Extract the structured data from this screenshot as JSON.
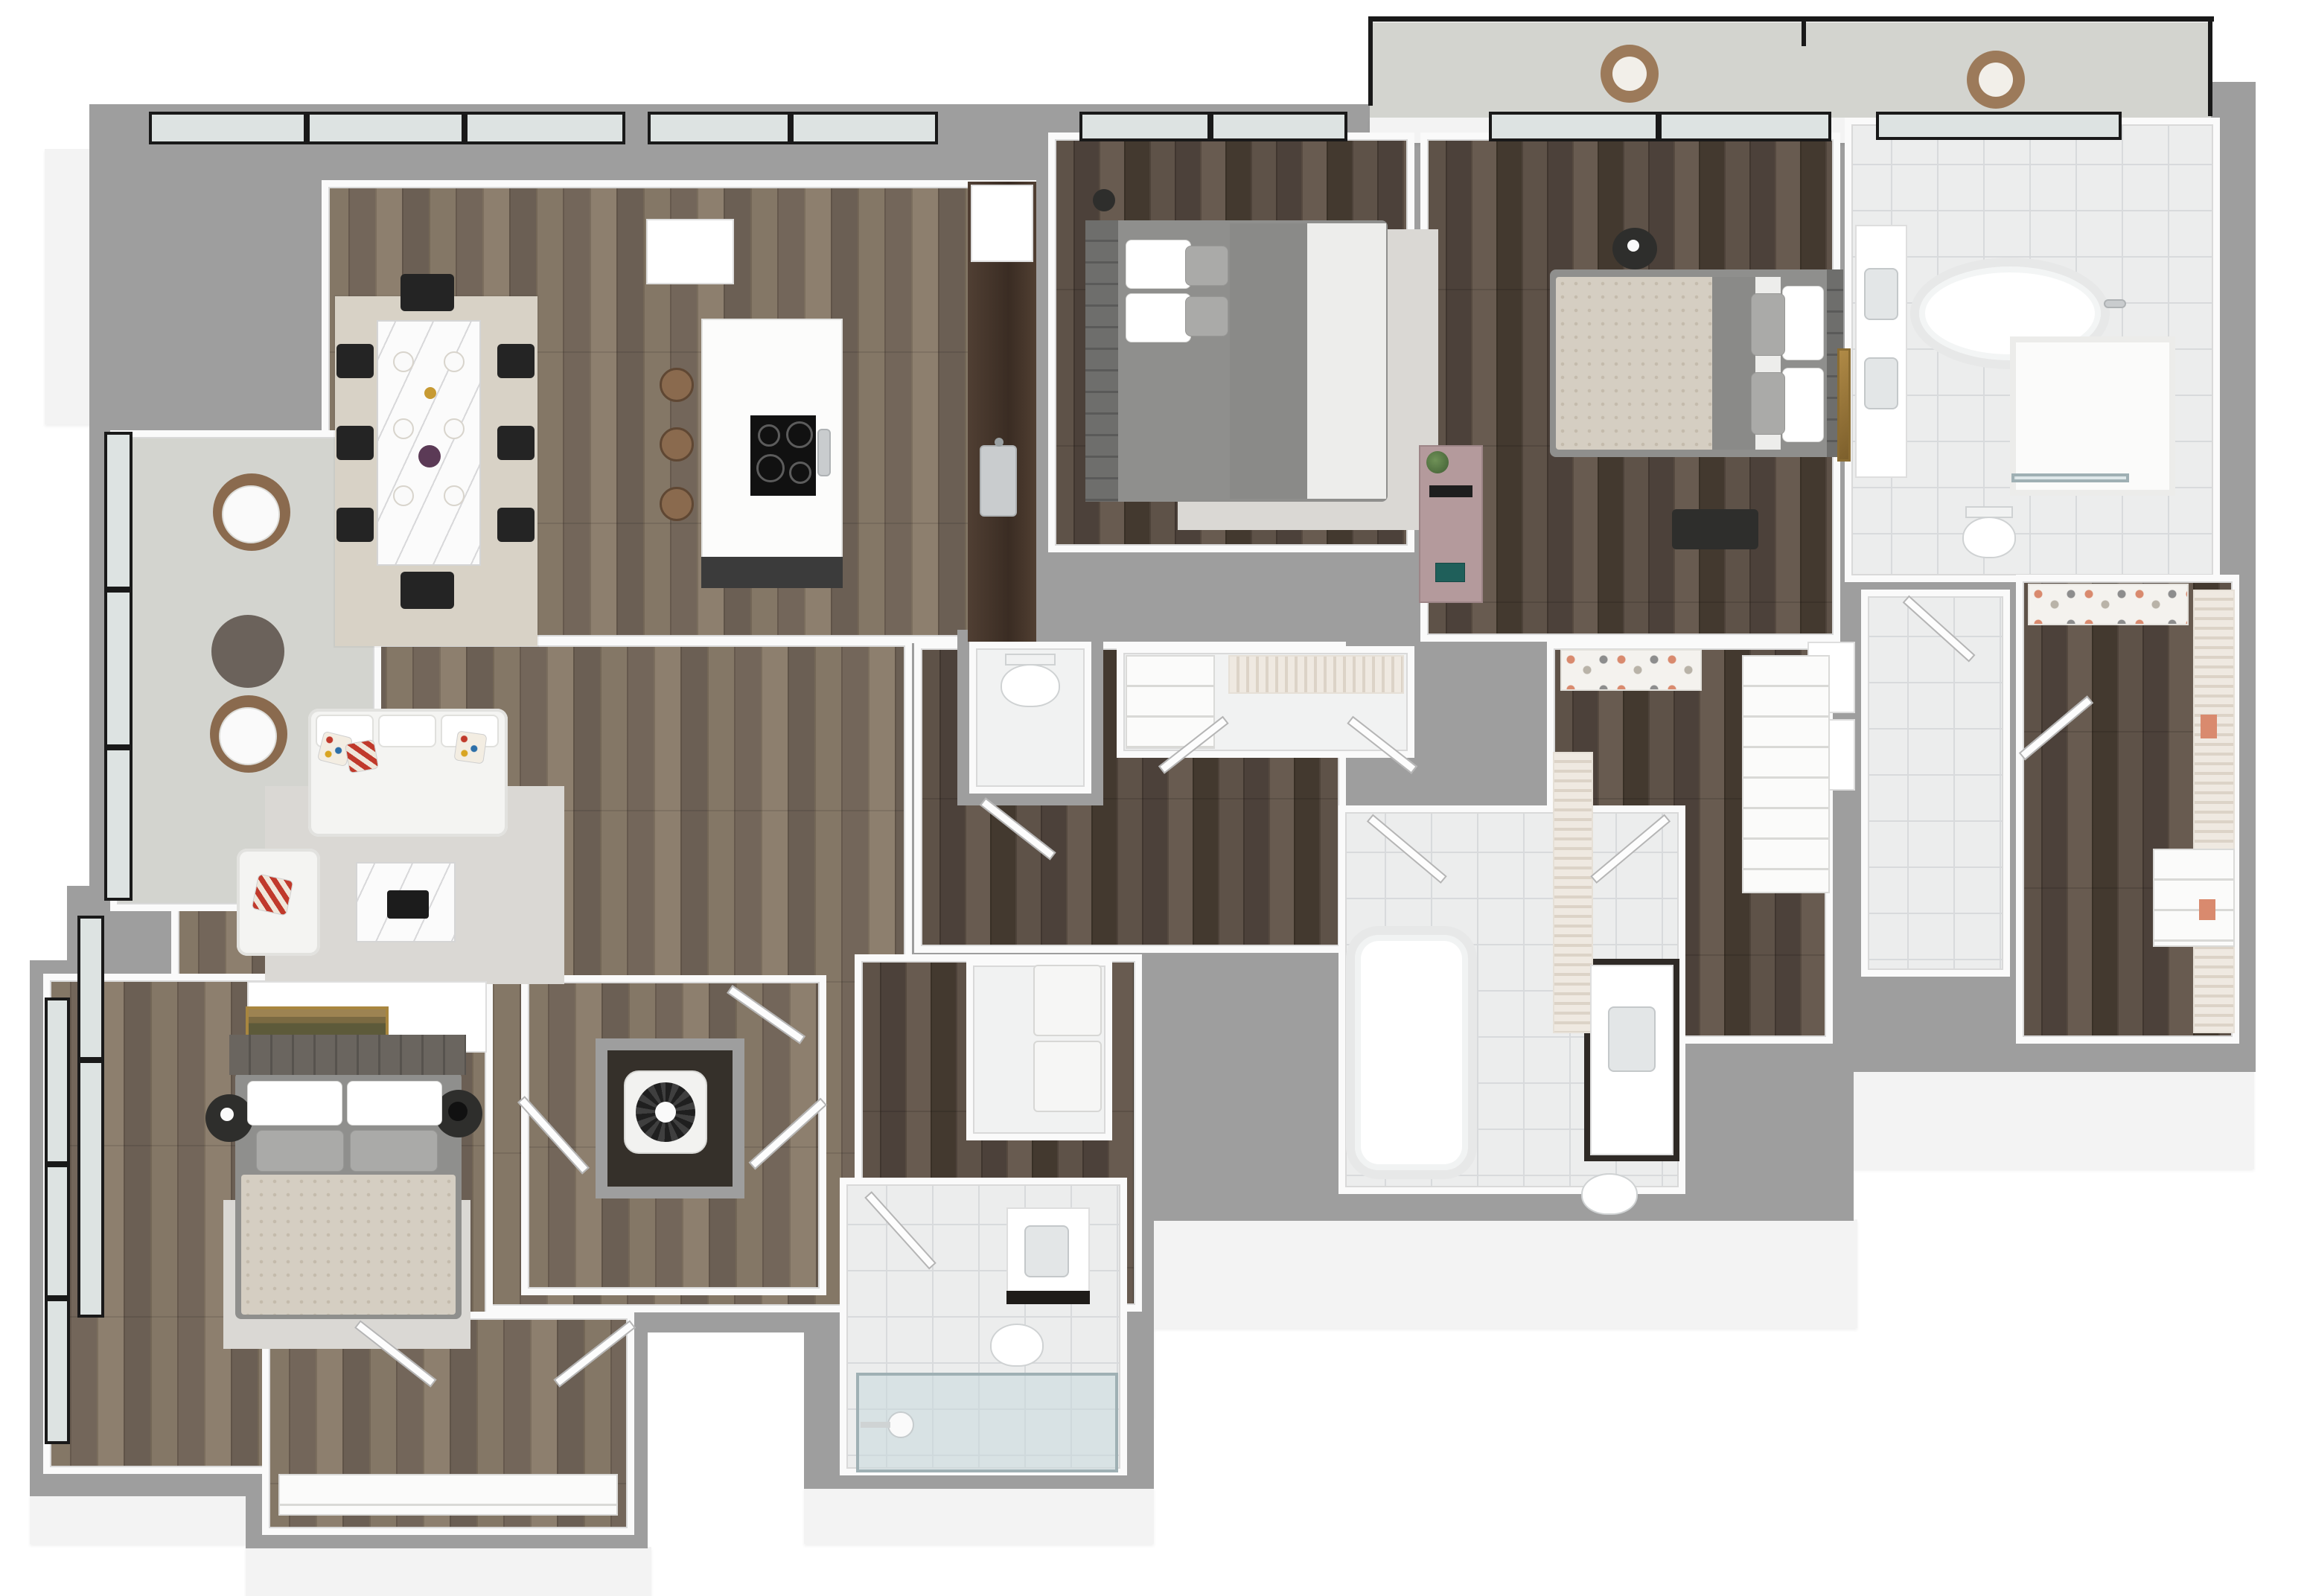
{
  "meta": {
    "title": "3D rendered apartment floor plan, isometric top-down view, no text labels"
  },
  "palette": {
    "wall": "#9e9e9e",
    "face": "#f3f3f3",
    "white": "#fafafa",
    "glass": "#dde3e2",
    "frame": "#191919",
    "tile": "#eceded",
    "tileLine": "#d8dadc",
    "balcony": "#d3d4cf",
    "rugBeige": "#d8d2c6",
    "rugGray": "#dad8d4",
    "walnut": "#47372d",
    "steel": "#c9ccce",
    "brown": "#8a6a4e",
    "mauve": "#b49a9c",
    "gold": "#a8863f",
    "salmon": "#d98a6e",
    "bedBeige": "#d5cec2",
    "green": "#5d7a4a",
    "black": "#242424"
  },
  "scene": {
    "style": "photorealistic 3D dollhouse floor plan on white background",
    "rooms": [
      {
        "name": "dining-area",
        "floor": "wood",
        "furniture": [
          "marble-dining-table",
          "eight-black-chairs",
          "place-settings",
          "beige-area-rug"
        ]
      },
      {
        "name": "kitchen",
        "floor": "wood",
        "furniture": [
          "white-island-with-black-cooktop",
          "three-brown-bar-stools",
          "walnut-counter-with-double-sink",
          "white-cabinet"
        ]
      },
      {
        "name": "living-room",
        "floor": "wood",
        "furniture": [
          "white-sofa-with-colorful-pillows",
          "white-armchair",
          "marble-coffee-table",
          "light-gray-rug",
          "white-media-console"
        ]
      },
      {
        "name": "balcony-left",
        "floor": "concrete",
        "furniture": [
          "two-round-white-tables",
          "brown-chairs",
          "dark-round-side-table"
        ]
      },
      {
        "name": "bedroom-2",
        "floor": "dark-wood",
        "furniture": [
          "gray-upholstered-bed",
          "white-gray-pillows",
          "gray-rug",
          "arc-floor-lamp",
          "mauve-desk-with-monitor",
          "potted-plant",
          "closet-with-shelves"
        ]
      },
      {
        "name": "master-bedroom",
        "floor": "dark-wood",
        "furniture": [
          "beige-platform-bed",
          "gray-headboard",
          "round-black-nightstand-with-flowers",
          "dark-bench",
          "gold-wall-art",
          "mauve-desk-with-monitor"
        ]
      },
      {
        "name": "master-bathroom",
        "floor": "marble-tile",
        "furniture": [
          "freestanding-oval-tub",
          "walk-in-shower",
          "double-sink-vanity",
          "toilet"
        ]
      },
      {
        "name": "master-walk-in-closet",
        "floor": "dark-wood",
        "furniture": [
          "hanging-clothes-rack",
          "shoe-shelves",
          "white-shelving-unit"
        ]
      },
      {
        "name": "walk-in-closet-2",
        "floor": "dark-wood",
        "furniture": [
          "hanging-clothes-rack",
          "shoe-shelves",
          "white-wardrobe"
        ]
      },
      {
        "name": "closet-corridor",
        "floor": "marble-tile",
        "furniture": [
          "linen-closets"
        ]
      },
      {
        "name": "hallway",
        "floor": "dark-wood",
        "furniture": [
          "white-interior-doors"
        ]
      },
      {
        "name": "powder-room",
        "floor": "white",
        "furniture": [
          "toilet"
        ]
      },
      {
        "name": "bathroom-2",
        "floor": "marble-tile",
        "furniture": [
          "alcove-tub",
          "dark-vanity-with-sink",
          "toilet",
          "double-doors"
        ]
      },
      {
        "name": "laundry-closet",
        "floor": "white",
        "furniture": [
          "stacked-washer-dryer"
        ]
      },
      {
        "name": "mechanical-closet",
        "floor": "dark",
        "furniture": [
          "hvac-fan-unit"
        ]
      },
      {
        "name": "bathroom-3",
        "floor": "marble-tile",
        "furniture": [
          "glass-shower",
          "vanity",
          "toilet"
        ]
      },
      {
        "name": "bedroom-1",
        "floor": "wood",
        "furniture": [
          "gray-platform-bed-beige-duvet",
          "tufted-headboard",
          "gold-landscape-painting",
          "two-dark-nightstands",
          "black-lamp",
          "beige-rug",
          "closet-with-double-doors-and-shelf"
        ]
      },
      {
        "name": "closet-1",
        "floor": "wood",
        "furniture": [
          "double-doors",
          "white-shelf-band"
        ]
      },
      {
        "name": "terrace-top-right",
        "floor": "concrete",
        "furniture": [
          "glass-railing",
          "two-brown-lounge-chairs"
        ]
      }
    ],
    "windows": [
      "dining-top",
      "kitchen-top",
      "bedroom2-top",
      "master-sliding-doors",
      "master-bath-top",
      "balcony-left-glazing",
      "living-left-glazing",
      "bedroom1-left-glazing"
    ]
  }
}
